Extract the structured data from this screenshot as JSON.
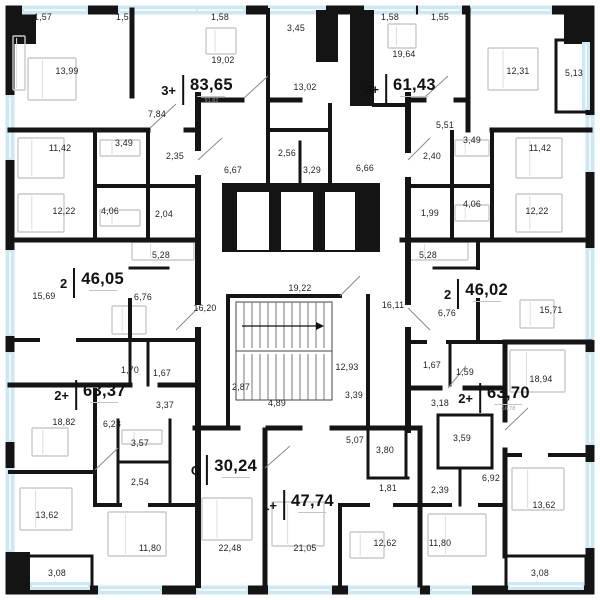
{
  "floor_plan": {
    "wall_color": "#141414",
    "window_color": "#cde8f3",
    "apartments": [
      {
        "type": "3+",
        "area": "83,65",
        "sub": "91,82",
        "x": 197,
        "y": 90
      },
      {
        "type": "2+",
        "area": "61,43",
        "sub": "",
        "x": 400,
        "y": 89
      },
      {
        "type": "2",
        "area": "46,05",
        "sub": "",
        "x": 92,
        "y": 283
      },
      {
        "type": "2",
        "area": "46,02",
        "sub": "",
        "x": 476,
        "y": 294
      },
      {
        "type": "2+",
        "area": "63,37",
        "sub": "",
        "x": 90,
        "y": 395
      },
      {
        "type": "2+",
        "area": "63,70",
        "sub": "66,78",
        "x": 494,
        "y": 398
      },
      {
        "type": "С",
        "area": "30,24",
        "sub": "",
        "x": 224,
        "y": 470
      },
      {
        "type": "1+",
        "area": "47,74",
        "sub": "",
        "x": 298,
        "y": 505
      }
    ],
    "rooms": [
      {
        "v": "1,57",
        "x": 43,
        "y": 17
      },
      {
        "v": "1,57",
        "x": 125,
        "y": 17
      },
      {
        "v": "1,58",
        "x": 220,
        "y": 17
      },
      {
        "v": "3,45",
        "x": 296,
        "y": 28
      },
      {
        "v": "1,58",
        "x": 390,
        "y": 17
      },
      {
        "v": "1,55",
        "x": 440,
        "y": 17
      },
      {
        "v": "5,13",
        "x": 574,
        "y": 73
      },
      {
        "v": "13,99",
        "x": 67,
        "y": 71
      },
      {
        "v": "19,02",
        "x": 223,
        "y": 60
      },
      {
        "v": "13,02",
        "x": 305,
        "y": 87
      },
      {
        "v": "19,64",
        "x": 404,
        "y": 54
      },
      {
        "v": "12,31",
        "x": 518,
        "y": 71
      },
      {
        "v": "7,84",
        "x": 157,
        "y": 114
      },
      {
        "v": "5,51",
        "x": 445,
        "y": 125
      },
      {
        "v": "3,49",
        "x": 124,
        "y": 143
      },
      {
        "v": "2,35",
        "x": 175,
        "y": 156
      },
      {
        "v": "2,56",
        "x": 287,
        "y": 153
      },
      {
        "v": "3,29",
        "x": 312,
        "y": 170
      },
      {
        "v": "6,66",
        "x": 365,
        "y": 168
      },
      {
        "v": "2,40",
        "x": 432,
        "y": 156
      },
      {
        "v": "3,49",
        "x": 472,
        "y": 140
      },
      {
        "v": "11,42",
        "x": 60,
        "y": 148
      },
      {
        "v": "11,42",
        "x": 540,
        "y": 148
      },
      {
        "v": "6,67",
        "x": 233,
        "y": 170
      },
      {
        "v": "4,06",
        "x": 110,
        "y": 211
      },
      {
        "v": "2,04",
        "x": 164,
        "y": 214
      },
      {
        "v": "1,99",
        "x": 430,
        "y": 213
      },
      {
        "v": "4,06",
        "x": 472,
        "y": 204
      },
      {
        "v": "12,22",
        "x": 64,
        "y": 211
      },
      {
        "v": "12,22",
        "x": 537,
        "y": 211
      },
      {
        "v": "5,28",
        "x": 161,
        "y": 255
      },
      {
        "v": "5,28",
        "x": 428,
        "y": 255
      },
      {
        "v": "15,69",
        "x": 44,
        "y": 296
      },
      {
        "v": "15,71",
        "x": 551,
        "y": 310
      },
      {
        "v": "6,76",
        "x": 143,
        "y": 297
      },
      {
        "v": "6,76",
        "x": 447,
        "y": 313
      },
      {
        "v": "16,20",
        "x": 205,
        "y": 308
      },
      {
        "v": "19,22",
        "x": 300,
        "y": 288
      },
      {
        "v": "16,11",
        "x": 393,
        "y": 305
      },
      {
        "v": "12,93",
        "x": 347,
        "y": 367
      },
      {
        "v": "1,70",
        "x": 130,
        "y": 370
      },
      {
        "v": "1,67",
        "x": 162,
        "y": 373
      },
      {
        "v": "1,67",
        "x": 432,
        "y": 365
      },
      {
        "v": "1,59",
        "x": 465,
        "y": 372
      },
      {
        "v": "18,94",
        "x": 541,
        "y": 379
      },
      {
        "v": "2,87",
        "x": 241,
        "y": 387
      },
      {
        "v": "3,39",
        "x": 354,
        "y": 395
      },
      {
        "v": "18,82",
        "x": 64,
        "y": 422
      },
      {
        "v": "6,28",
        "x": 112,
        "y": 424
      },
      {
        "v": "3,37",
        "x": 165,
        "y": 405
      },
      {
        "v": "3,57",
        "x": 140,
        "y": 443
      },
      {
        "v": "4,89",
        "x": 277,
        "y": 403
      },
      {
        "v": "5,07",
        "x": 355,
        "y": 440
      },
      {
        "v": "3,18",
        "x": 440,
        "y": 403
      },
      {
        "v": "3,59",
        "x": 462,
        "y": 438
      },
      {
        "v": "3,80",
        "x": 385,
        "y": 450
      },
      {
        "v": "2,54",
        "x": 140,
        "y": 482
      },
      {
        "v": "1,81",
        "x": 388,
        "y": 488
      },
      {
        "v": "2,39",
        "x": 440,
        "y": 490
      },
      {
        "v": "6,92",
        "x": 491,
        "y": 478
      },
      {
        "v": "13,62",
        "x": 47,
        "y": 515
      },
      {
        "v": "13,62",
        "x": 544,
        "y": 505
      },
      {
        "v": "11,80",
        "x": 150,
        "y": 548
      },
      {
        "v": "22,48",
        "x": 230,
        "y": 548
      },
      {
        "v": "21,05",
        "x": 305,
        "y": 548
      },
      {
        "v": "12,62",
        "x": 385,
        "y": 543
      },
      {
        "v": "11,80",
        "x": 440,
        "y": 543
      },
      {
        "v": "3,08",
        "x": 57,
        "y": 573
      },
      {
        "v": "3,08",
        "x": 540,
        "y": 573
      }
    ]
  }
}
